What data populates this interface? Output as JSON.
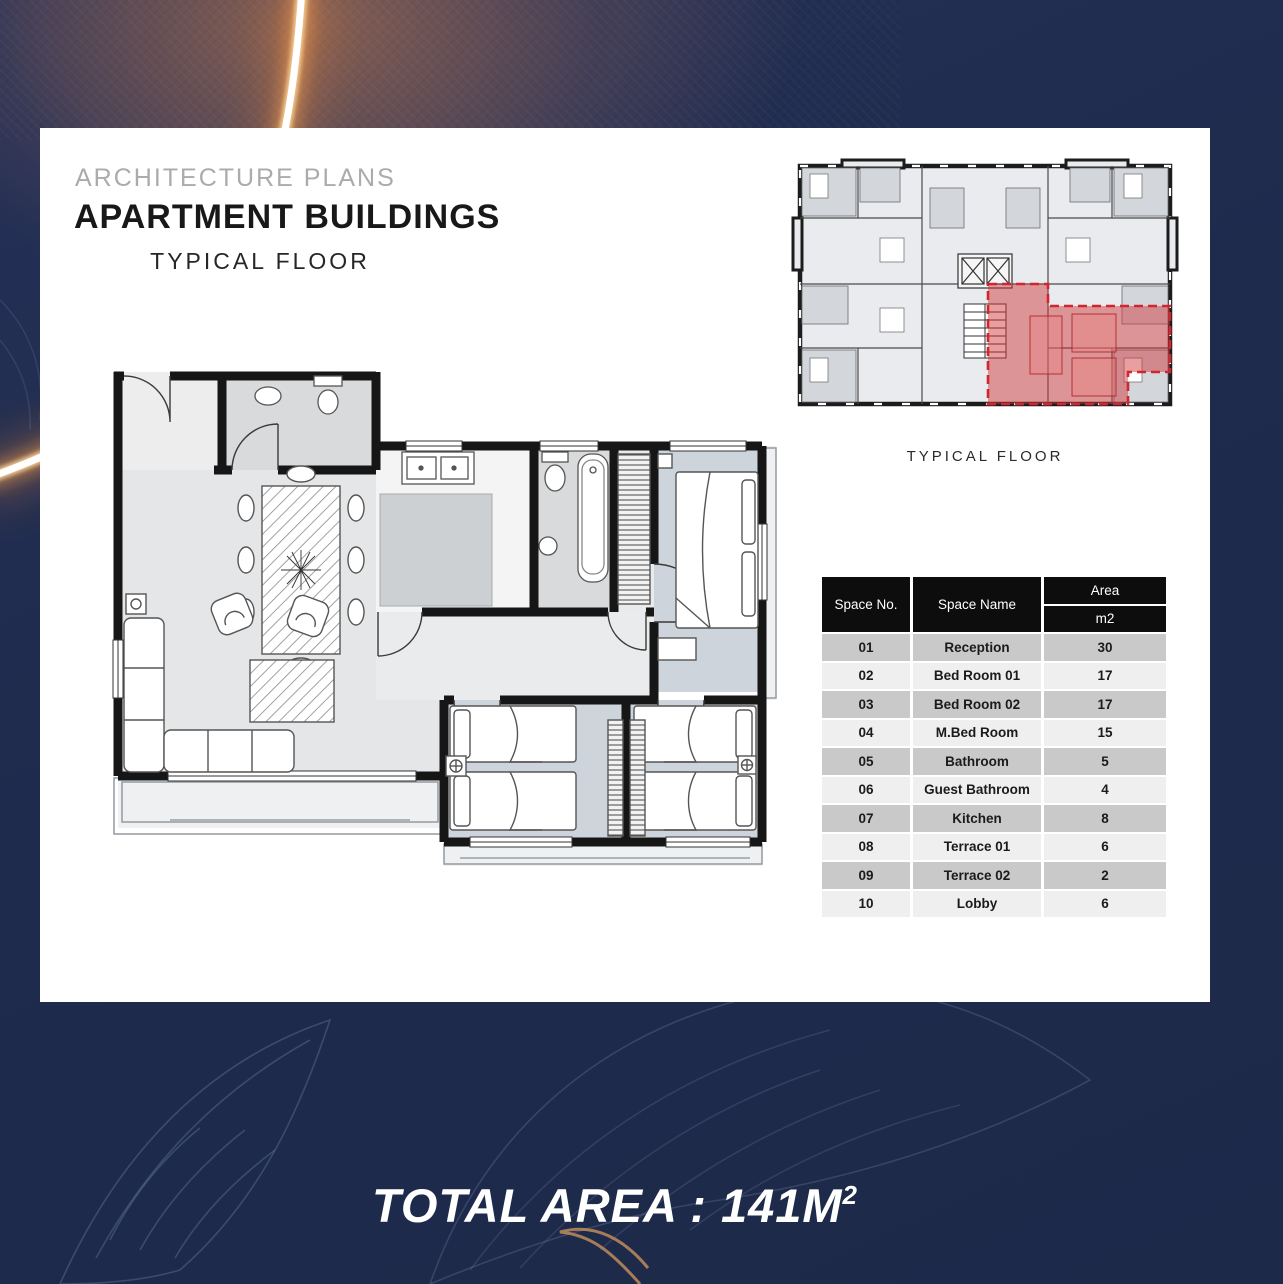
{
  "slide": {
    "eyebrow": "ARCHITECTURE PLANS",
    "title": "APARTMENT BUILDINGS",
    "subtitle": "TYPICAL FLOOR",
    "overview_caption": "TYPICAL FLOOR",
    "total_area": "TOTAL AREA : 141M",
    "total_area_sup": "2"
  },
  "table": {
    "headers": {
      "space_no": "Space No.",
      "space_name": "Space Name",
      "area": "Area",
      "area_unit": "m2"
    },
    "rows": [
      {
        "no": "01",
        "name": "Reception",
        "area": "30"
      },
      {
        "no": "02",
        "name": "Bed Room 01",
        "area": "17"
      },
      {
        "no": "03",
        "name": "Bed Room 02",
        "area": "17"
      },
      {
        "no": "04",
        "name": "M.Bed Room",
        "area": "15"
      },
      {
        "no": "05",
        "name": "Bathroom",
        "area": "5"
      },
      {
        "no": "06",
        "name": "Guest Bathroom",
        "area": "4"
      },
      {
        "no": "07",
        "name": "Kitchen",
        "area": "8"
      },
      {
        "no": "08",
        "name": "Terrace 01",
        "area": "6"
      },
      {
        "no": "09",
        "name": "Terrace 02",
        "area": "2"
      },
      {
        "no": "10",
        "name": "Lobby",
        "area": "6"
      }
    ]
  },
  "colors": {
    "background_navy": "#1e2a4b",
    "card_white": "#ffffff",
    "highlight_red": "#c8232a",
    "table_header_black": "#0d0d0d",
    "row_dark": "#c9c9c9",
    "row_light": "#efefef",
    "glow_orange": "#ffb25e"
  }
}
